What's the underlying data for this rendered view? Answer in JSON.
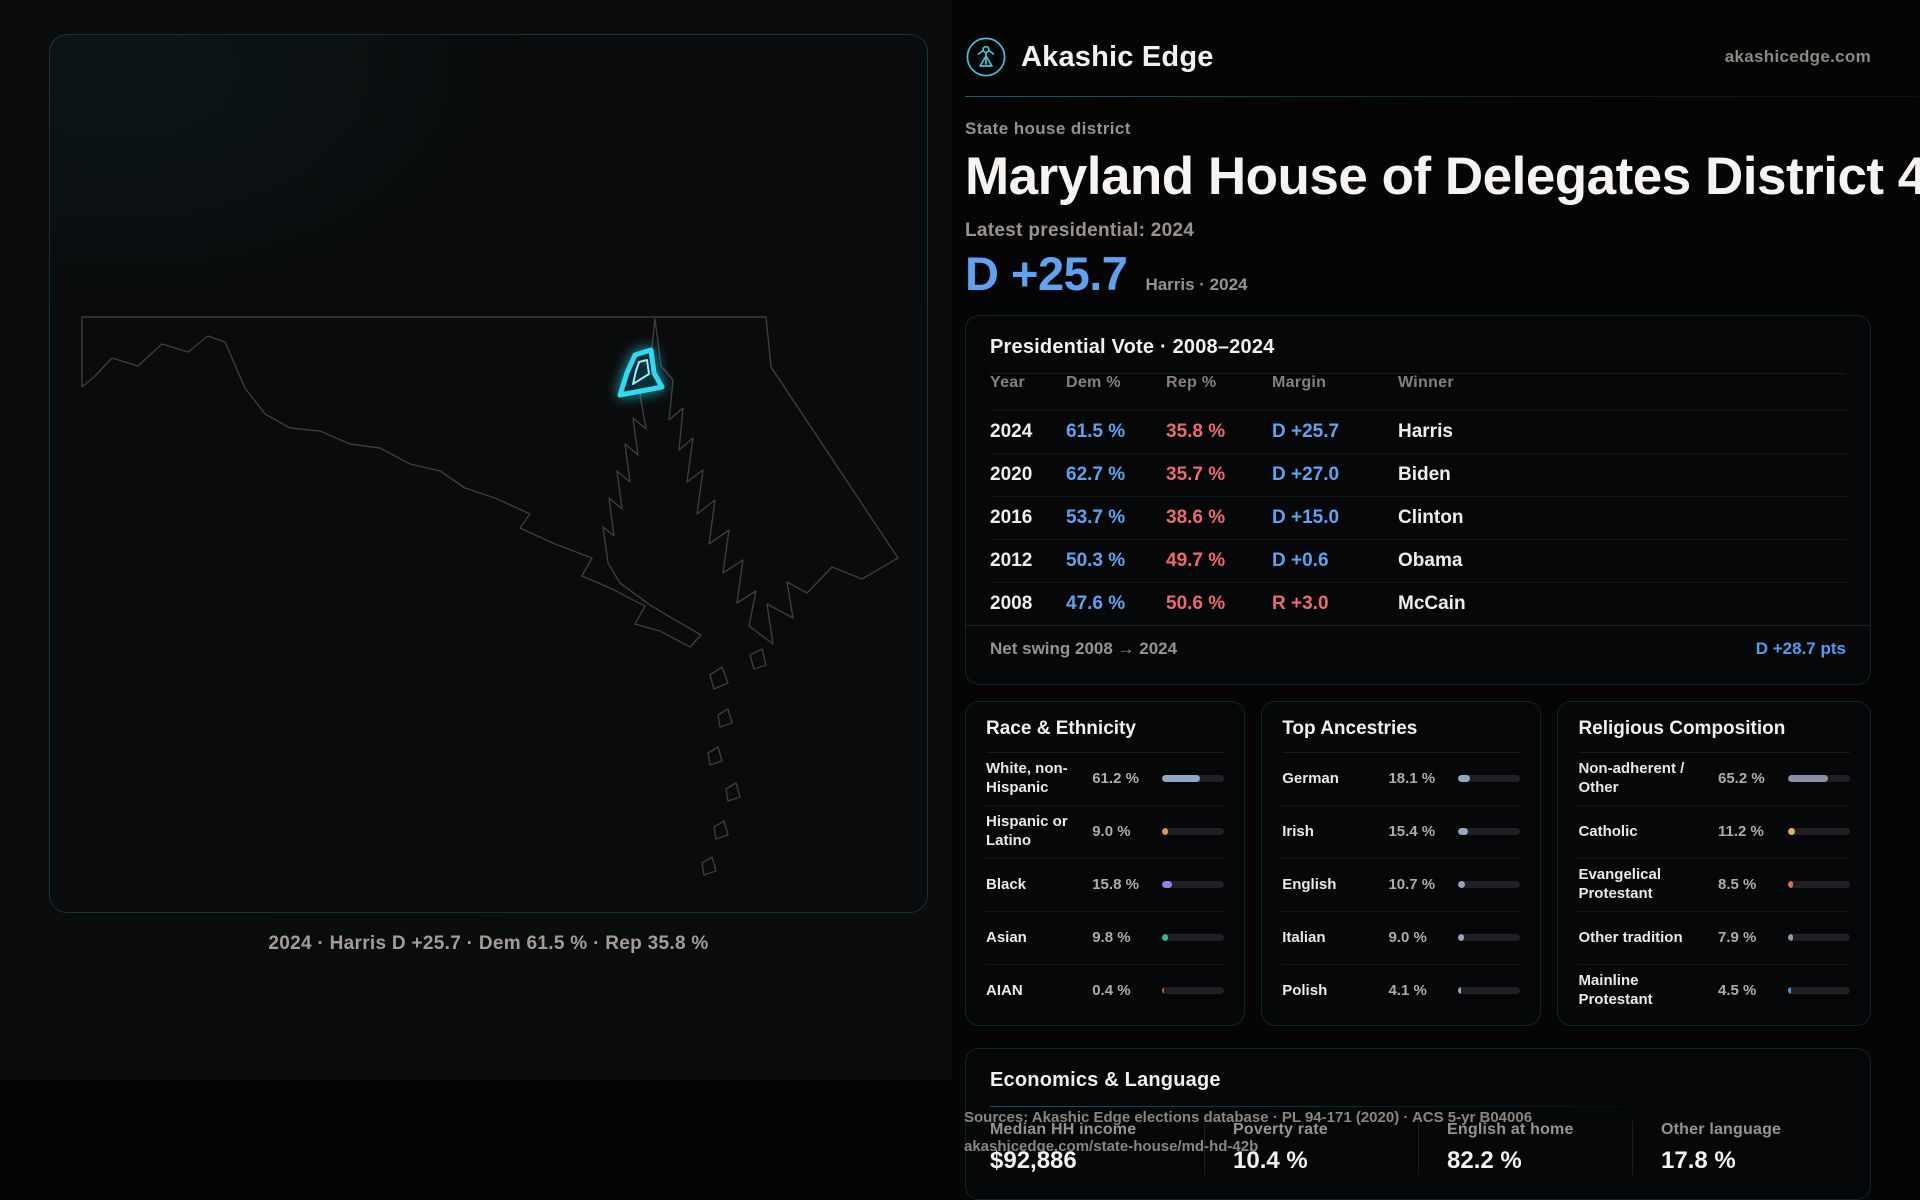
{
  "colors": {
    "dem_blue": "#5da3f2",
    "rep_red": "#ed6a6e",
    "accent_cyan": "#2fd9f2"
  },
  "brand": {
    "name": "Akashic Edge",
    "domain": "akashicedge.com"
  },
  "page": {
    "kicker": "State house district",
    "title": "Maryland House of Delegates District 42B",
    "latest_label": "Latest presidential: 2024",
    "headline_margin": "D +25.7",
    "headline_note": "Harris · 2024"
  },
  "map": {
    "caption": "2024 · Harris D +25.7 · Dem 61.5 % · Rep 35.8 %"
  },
  "presidential": {
    "title": "Presidential Vote · 2008–2024",
    "columns": [
      "Year",
      "Dem %",
      "Rep %",
      "Margin",
      "Winner"
    ],
    "rows": [
      {
        "year": "2024",
        "dem": "61.5 %",
        "rep": "35.8 %",
        "margin": "D +25.7",
        "party": "D",
        "winner": "Harris"
      },
      {
        "year": "2020",
        "dem": "62.7 %",
        "rep": "35.7 %",
        "margin": "D +27.0",
        "party": "D",
        "winner": "Biden"
      },
      {
        "year": "2016",
        "dem": "53.7 %",
        "rep": "38.6 %",
        "margin": "D +15.0",
        "party": "D",
        "winner": "Clinton"
      },
      {
        "year": "2012",
        "dem": "50.3 %",
        "rep": "49.7 %",
        "margin": "D +0.6",
        "party": "D",
        "winner": "Obama"
      },
      {
        "year": "2008",
        "dem": "47.6 %",
        "rep": "50.6 %",
        "margin": "R +3.0",
        "party": "R",
        "winner": "McCain"
      }
    ],
    "swing_label": "Net swing 2008 → 2024",
    "swing_value": "D +28.7 pts"
  },
  "demographics": [
    {
      "title": "Race & Ethnicity",
      "rows": [
        {
          "label": "White, non-Hispanic",
          "value": "61.2 %",
          "pct": 61.2,
          "color": "#8fa7c4"
        },
        {
          "label": "Hispanic or Latino",
          "value": "9.0 %",
          "pct": 9.0,
          "color": "#e09b3d"
        },
        {
          "label": "Black",
          "value": "15.8 %",
          "pct": 15.8,
          "color": "#9181ee"
        },
        {
          "label": "Asian",
          "value": "9.8 %",
          "pct": 9.8,
          "color": "#35b694"
        },
        {
          "label": "AIAN",
          "value": "0.4 %",
          "pct": 0.4,
          "color": "#c65a33"
        }
      ]
    },
    {
      "title": "Top Ancestries",
      "rows": [
        {
          "label": "German",
          "value": "18.1 %",
          "pct": 18.1,
          "color": "#93a7c4"
        },
        {
          "label": "Irish",
          "value": "15.4 %",
          "pct": 15.4,
          "color": "#93a7c4"
        },
        {
          "label": "English",
          "value": "10.7 %",
          "pct": 10.7,
          "color": "#93a7c4"
        },
        {
          "label": "Italian",
          "value": "9.0 %",
          "pct": 9.0,
          "color": "#93a7c4"
        },
        {
          "label": "Polish",
          "value": "4.1 %",
          "pct": 4.1,
          "color": "#93a7c4"
        }
      ]
    },
    {
      "title": "Religious Composition",
      "rows": [
        {
          "label": "Non-adherent / Other",
          "value": "65.2 %",
          "pct": 65.2,
          "color": "#8b90a8"
        },
        {
          "label": "Catholic",
          "value": "11.2 %",
          "pct": 11.2,
          "color": "#e3b53c"
        },
        {
          "label": "Evangelical Protestant",
          "value": "8.5 %",
          "pct": 8.5,
          "color": "#e06a62"
        },
        {
          "label": "Other tradition",
          "value": "7.9 %",
          "pct": 7.9,
          "color": "#9097a3"
        },
        {
          "label": "Mainline Protestant",
          "value": "4.5 %",
          "pct": 4.5,
          "color": "#4a8fe8"
        }
      ]
    }
  ],
  "economics": {
    "title": "Economics & Language",
    "stats": [
      {
        "label": "Median HH income",
        "value": "$92,886"
      },
      {
        "label": "Poverty rate",
        "value": "10.4 %"
      },
      {
        "label": "English at home",
        "value": "82.2 %"
      },
      {
        "label": "Other language",
        "value": "17.8 %"
      }
    ]
  },
  "source": {
    "line1": "Sources: Akashic Edge elections database · PL 94-171 (2020) · ACS 5-yr B04006",
    "line2": "akashicedge.com/state-house/md-hd-42b"
  }
}
